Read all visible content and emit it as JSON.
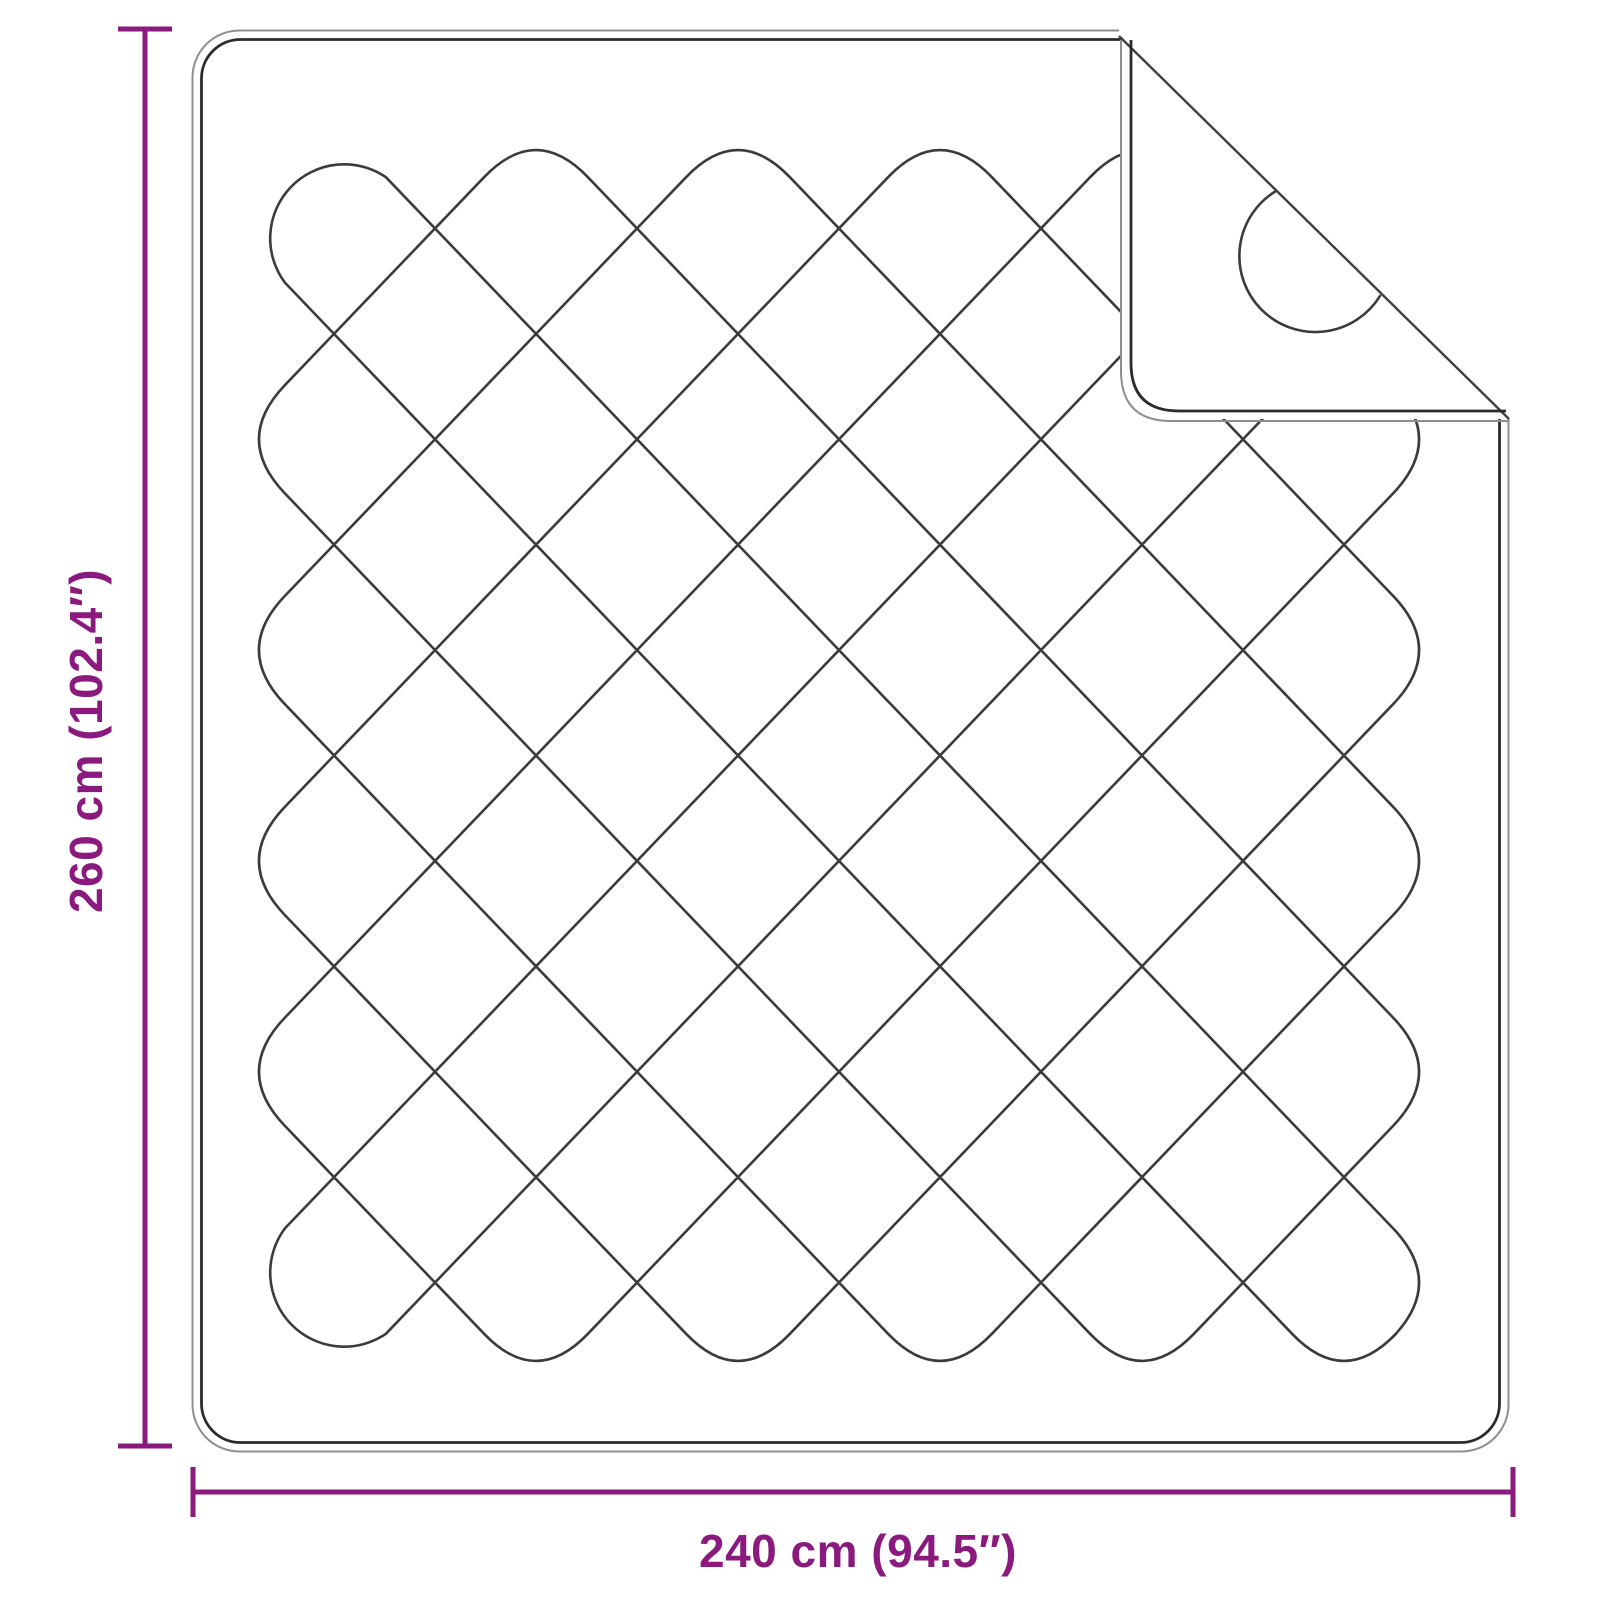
{
  "diagram": {
    "kind": "product-dimension-diagram",
    "subject": "quilted blanket with folded-back corner",
    "height_label": "260 cm (102.4″)",
    "width_label": "240 cm (94.5″)",
    "measurements": {
      "height_cm": 260,
      "height_in": 102.4,
      "width_cm": 240,
      "width_in": 94.5
    }
  },
  "colors": {
    "dimension_accent": "#8a1a7e",
    "quilt_line": "#3b3b3b",
    "outline_outer": "#8f8f8f",
    "outline_inner": "#2b2b2b",
    "background": "#ffffff"
  }
}
